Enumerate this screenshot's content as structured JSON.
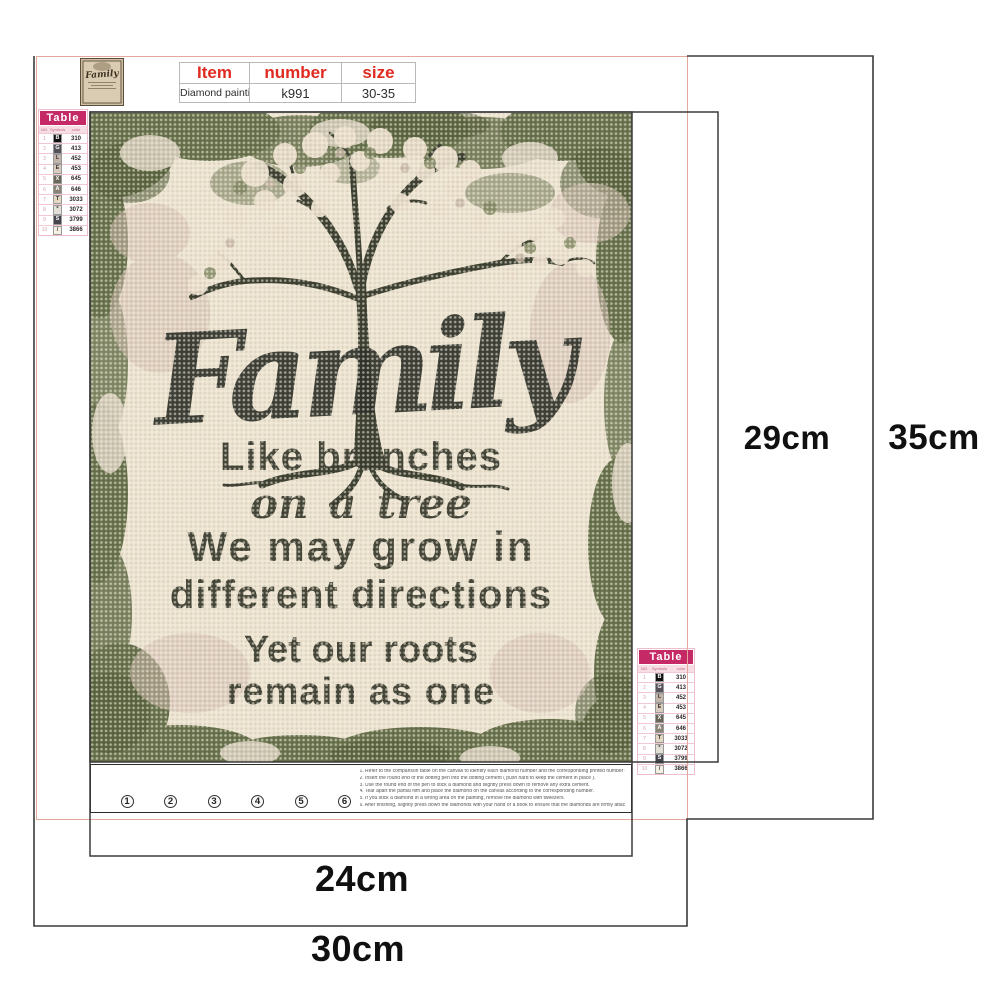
{
  "colors": {
    "accent_pink": "#c52a66",
    "header_red": "#e02b21",
    "frame_pink": "#e4a89d",
    "line_dark": "#3b3b3b"
  },
  "logo": {
    "title": "Family"
  },
  "spec_table": {
    "columns": [
      "Item",
      "number",
      "size"
    ],
    "rows": [
      [
        "Diamond painting",
        "k991",
        "30-35"
      ]
    ]
  },
  "color_table": {
    "title": "Table",
    "columns": [
      "NO.",
      "Symbols",
      "color"
    ],
    "rows": [
      {
        "no": "1",
        "sym": "B",
        "code": "310",
        "bg": "#101010",
        "fg": "#ffffff"
      },
      {
        "no": "2",
        "sym": "G",
        "code": "413",
        "bg": "#57525a",
        "fg": "#ffffff"
      },
      {
        "no": "3",
        "sym": "L",
        "code": "452",
        "bg": "#c3b5ab",
        "fg": "#3c342e"
      },
      {
        "no": "4",
        "sym": "E",
        "code": "453",
        "bg": "#d8ccc0",
        "fg": "#3c342e"
      },
      {
        "no": "5",
        "sym": "X",
        "code": "645",
        "bg": "#6a665a",
        "fg": "#ffffff"
      },
      {
        "no": "6",
        "sym": "A",
        "code": "646",
        "bg": "#8a8376",
        "fg": "#ffffff"
      },
      {
        "no": "7",
        "sym": "T",
        "code": "3033",
        "bg": "#e2d7c3",
        "fg": "#3c342e"
      },
      {
        "no": "8",
        "sym": "*",
        "code": "3072",
        "bg": "#e2dfd7",
        "fg": "#3c342e"
      },
      {
        "no": "9",
        "sym": "S",
        "code": "3799",
        "bg": "#45434c",
        "fg": "#ffffff"
      },
      {
        "no": "10",
        "sym": "/",
        "code": "3866",
        "bg": "#f6f0e4",
        "fg": "#3c342e"
      }
    ]
  },
  "canvas_text": {
    "title": "Family",
    "lines": [
      "Like branches",
      "on a tree",
      "We may grow in",
      "different directions",
      "Yet our roots",
      "remain as one"
    ]
  },
  "steps": [
    {
      "n": "1"
    },
    {
      "n": "2"
    },
    {
      "n": "3"
    },
    {
      "n": "4"
    },
    {
      "n": "5"
    },
    {
      "n": "6"
    }
  ],
  "instructions": [
    "1. Refer to the comparison table on the canvas to identify each diamond number and the corresponding printed number on the canvas.",
    "2. Insert the round end of the dotting pen into the dotting cement ( push hard to keep the cement in place ).",
    "3. Use the round end of the pen to stick a diamond and slightly press down to remove any extra cement.",
    "4. Tear apart the partial film and place the diamond on the canvas according to the corresponding number.",
    "5. If you stick a diamond in a wrong area on the painting, remove the diamond with tweezers.",
    "6. After finishing, slightly press down the diamonds with your hand or a book to ensure that the diamonds are firmly attached."
  ],
  "dimensions": {
    "inner_width": "24cm",
    "outer_width": "30cm",
    "inner_height": "29cm",
    "outer_height": "35cm"
  }
}
